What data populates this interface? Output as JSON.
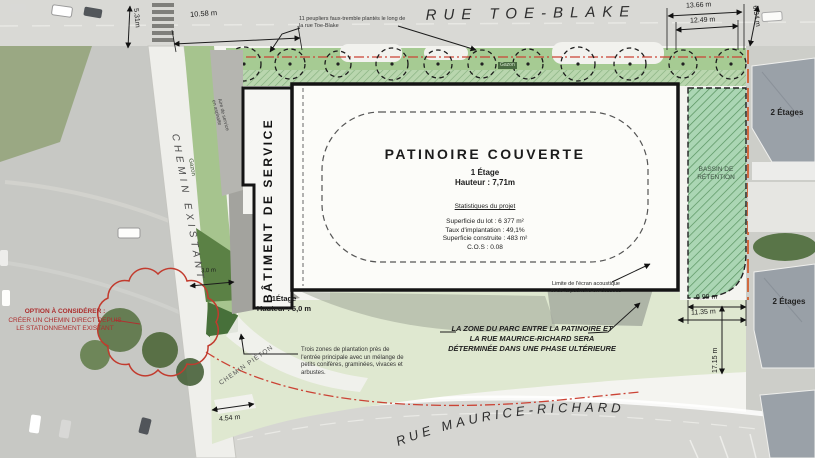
{
  "site_plan": {
    "streets": {
      "top_street": "RUE TOE-BLAKE",
      "bottom_street": "RUE MAURICE-RICHARD",
      "existing_road": "CHEMIN EXISTANT",
      "pedestrian_path": "CHEMIN PIÉTON"
    },
    "rink": {
      "title": "PATINOIRE COUVERTE",
      "storeys": "1 Étage",
      "height": "Hauteur : 7,71m",
      "stats_heading": "Statistiques du projet",
      "stats": [
        "Superficie du lot : 6 377 m²",
        "Taux d'implantation : 49,1%",
        "Superficie construite : 483 m²",
        "C.O.S : 0.08"
      ]
    },
    "service_building": {
      "name": "BÂTIMENT DE SERVICE",
      "storeys": "1Étage",
      "height": "Hauteur : 5,0 m",
      "yard_label": "Aire de service en asphalte"
    },
    "basin_label": "BASSIN DE RÉTENTION",
    "grass_label": "Gazon",
    "houses": {
      "labels": [
        "2 Étages",
        "2 Étages"
      ]
    },
    "callouts": {
      "poplars": "11 peupliers faux-tremble plantés le long de la rue Toe-Blake",
      "acoustic_screen": "Limite de l'écran acoustique et de la patinoire en-dessous",
      "planting_zones": "Trois zones de plantation près de l'entrée principale avec un mélange de petits conifères, graminées, vivaces et arbustes.",
      "park_phase": "LA ZONE DU PARC ENTRE LA PATINOIRE ET LA RUE MAURICE-RICHARD SERA DÉTERMINÉE DANS UNE PHASE ULTÉRIEURE",
      "option_title": "OPTION À CONSIDÉRER :",
      "option_body": "CRÉER UN CHEMIN DIRECT DEPUIS LE STATIONNEMENT EXISTANT"
    },
    "dimensions": {
      "top_left_vertical": "5.31m",
      "top_left": "10.58 m",
      "top_right_outer": "13.66 m",
      "top_right_inner": "12.49 m",
      "top_right_vertical": "6.34 m",
      "right_upper": "9.99 m",
      "right_lower": "11.35 m",
      "right_vertical": "17.15 m",
      "bottom_left": "4.54 m",
      "road_width": "3.0 m"
    },
    "colors": {
      "park_green": "#dfe8d0",
      "strip_green": "#a6cb93",
      "basin_green": "#abd6b4",
      "dark_green": "#4e7a3a",
      "revision_red": "#c23b2e",
      "line_black": "#1a1a1a"
    }
  }
}
